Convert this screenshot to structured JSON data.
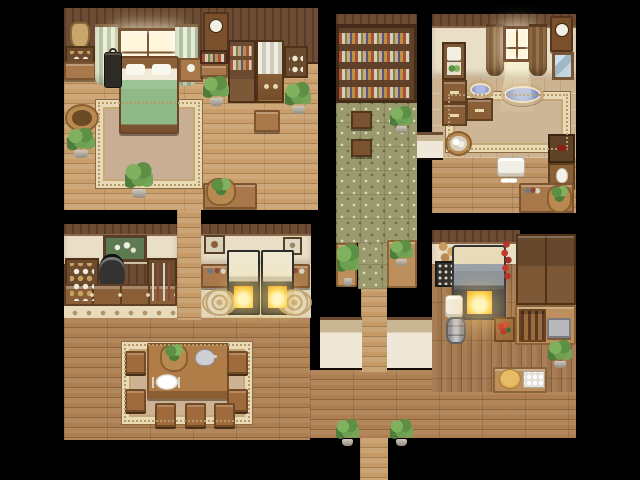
{
  "scene": {
    "kind": "rpg-top-down-interior-map",
    "rooms": [
      "bedroom",
      "library-corridor",
      "bathroom",
      "apothecary",
      "oven-room",
      "kitchen",
      "dining-hall"
    ]
  },
  "canvas": {
    "width": 640,
    "height": 480,
    "background": "#000000"
  },
  "palette": {
    "void": "#000000",
    "hall_floor": "#ac7e50",
    "light_floor": "#c59a66",
    "kitchen_floor": "#a0744a",
    "library_tile": "#9a9a6e",
    "bath_tile": "#ccb492",
    "cream_tile": "#e4d7b8",
    "wall_wood": "#6d4c33",
    "wall_cream": "#e9dfc6",
    "wall_plaster": "#efe8d8",
    "rug_border": "#ead9b5",
    "bed_blanket": "#8fba88",
    "water_blue": "#7e8cc4",
    "fire_glow": "#ffd95e",
    "plant_green": "#5d8f44"
  },
  "sprites": [
    {
      "name": "hall-floor-left",
      "type": "floor-h",
      "x": 64,
      "y": 318,
      "w": 246,
      "h": 122
    },
    {
      "name": "hall-floor-right",
      "type": "floor-h",
      "x": 310,
      "y": 370,
      "w": 266,
      "h": 68
    },
    {
      "name": "exit-corridor-floor",
      "type": "floor-h-light",
      "x": 360,
      "y": 438,
      "w": 28,
      "h": 42
    },
    {
      "name": "mid-corridor-floor",
      "type": "floor-h-light",
      "x": 177,
      "y": 208,
      "w": 24,
      "h": 112
    },
    {
      "name": "center-walkway-floor",
      "type": "floor-h-light",
      "x": 361,
      "y": 287,
      "w": 26,
      "h": 85
    },
    {
      "name": "bedroom-floor",
      "type": "floor-h-light",
      "x": 64,
      "y": 64,
      "w": 254,
      "h": 146,
      "bg": "#c99e6a"
    },
    {
      "name": "bedroom-wall",
      "type": "wall-wood",
      "x": 64,
      "y": 8,
      "w": 254,
      "h": 56
    },
    {
      "name": "library-wall-cap",
      "type": "wall-wood",
      "x": 336,
      "y": 14,
      "w": 81,
      "h": 12
    },
    {
      "name": "library-bookshelf-wall",
      "type": "bookshelf-big",
      "x": 336,
      "y": 25,
      "w": 81,
      "h": 78
    },
    {
      "name": "library-floor",
      "type": "floor-green",
      "x": 336,
      "y": 103,
      "w": 81,
      "h": 140
    },
    {
      "name": "library-floor-strip",
      "type": "floor-green",
      "x": 358,
      "y": 243,
      "w": 29,
      "h": 46
    },
    {
      "name": "library-table-left",
      "type": "table-tan",
      "x": 336,
      "y": 243,
      "w": 21,
      "h": 44
    },
    {
      "name": "library-table-right",
      "type": "table-tan",
      "x": 387,
      "y": 240,
      "w": 30,
      "h": 48
    },
    {
      "name": "bathroom-wall-cap",
      "type": "wall-wood",
      "x": 432,
      "y": 14,
      "w": 144,
      "h": 14
    },
    {
      "name": "bathroom-wall",
      "type": "wall-cream",
      "x": 432,
      "y": 26,
      "w": 144,
      "h": 52
    },
    {
      "name": "bathroom-tile-floor",
      "type": "floor-tile-beige",
      "x": 432,
      "y": 78,
      "w": 144,
      "h": 80
    },
    {
      "name": "bathroom-wood-floor",
      "type": "floor-h-light",
      "x": 432,
      "y": 158,
      "w": 144,
      "h": 55,
      "bg": "#bc8f5e"
    },
    {
      "name": "apothecary-wall-cap",
      "type": "wall-wood",
      "x": 64,
      "y": 224,
      "w": 113,
      "h": 12
    },
    {
      "name": "apothecary-wall",
      "type": "wall-cream",
      "x": 64,
      "y": 234,
      "w": 113,
      "h": 32
    },
    {
      "name": "apothecary-panel",
      "type": "wall-wood",
      "x": 64,
      "y": 264,
      "w": 113,
      "h": 42
    },
    {
      "name": "apothecary-tile-strip",
      "type": "tile-strip",
      "x": 64,
      "y": 304,
      "w": 113,
      "h": 14
    },
    {
      "name": "ovenroom-wall-cap",
      "type": "wall-wood",
      "x": 201,
      "y": 224,
      "w": 110,
      "h": 12
    },
    {
      "name": "ovenroom-wall",
      "type": "wall-cream",
      "x": 201,
      "y": 234,
      "w": 110,
      "h": 32
    },
    {
      "name": "ovenroom-floor",
      "type": "floor-tile-cream",
      "x": 201,
      "y": 264,
      "w": 110,
      "h": 54
    },
    {
      "name": "south-wall-left",
      "type": "wall-plaster",
      "x": 320,
      "y": 317,
      "w": 42,
      "h": 53
    },
    {
      "name": "south-wall-right",
      "type": "wall-plaster",
      "x": 387,
      "y": 317,
      "w": 51,
      "h": 53
    },
    {
      "name": "library-bath-wall",
      "type": "wall-plaster",
      "x": 417,
      "y": 132,
      "w": 26,
      "h": 28
    },
    {
      "name": "kitchen-wall-cap",
      "type": "wall-wood",
      "x": 432,
      "y": 230,
      "w": 88,
      "h": 14
    },
    {
      "name": "kitchen-wall",
      "type": "wall-cream",
      "x": 432,
      "y": 242,
      "w": 88,
      "h": 46
    },
    {
      "name": "kitchen-floor",
      "type": "floor-v",
      "x": 432,
      "y": 264,
      "w": 144,
      "h": 128
    },
    {
      "name": "bedroom-rug",
      "type": "rug",
      "x": 96,
      "y": 100,
      "w": 106,
      "h": 88,
      "bg": "#c7ae94"
    },
    {
      "name": "bathroom-rug",
      "type": "rug",
      "x": 446,
      "y": 92,
      "w": 124,
      "h": 60,
      "bg": "#cdb695"
    },
    {
      "name": "dining-carpet",
      "type": "rug",
      "x": 122,
      "y": 342,
      "w": 130,
      "h": 82,
      "bg": "#cdb394"
    },
    {
      "name": "hanging-pouch",
      "type": "pouch",
      "x": 70,
      "y": 22,
      "w": 20,
      "h": 28
    },
    {
      "name": "blue-jar-shelf",
      "type": "shelf-unit",
      "x": 65,
      "y": 46,
      "w": 30,
      "h": 18
    },
    {
      "name": "bedroom-side-table",
      "type": "table",
      "x": 64,
      "y": 62,
      "w": 32,
      "h": 18
    },
    {
      "name": "bedroom-curtain-left",
      "type": "curtain-striped",
      "x": 95,
      "y": 24,
      "w": 23,
      "h": 62
    },
    {
      "name": "bedroom-window",
      "type": "window",
      "x": 118,
      "y": 28,
      "w": 60,
      "h": 40
    },
    {
      "name": "bedroom-curtain-right",
      "type": "curtain-striped",
      "x": 175,
      "y": 24,
      "w": 23,
      "h": 62
    },
    {
      "name": "bed",
      "type": "bed",
      "x": 119,
      "y": 56,
      "w": 60,
      "h": 78
    },
    {
      "name": "lantern",
      "type": "lantern",
      "x": 104,
      "y": 52,
      "w": 18,
      "h": 36
    },
    {
      "name": "nightstand",
      "type": "nightstand",
      "x": 179,
      "y": 58,
      "w": 24,
      "h": 24
    },
    {
      "name": "bedroom-wall-clock",
      "type": "clock",
      "x": 203,
      "y": 12,
      "w": 26,
      "h": 40
    },
    {
      "name": "bedroom-books-row",
      "type": "books-row",
      "x": 200,
      "y": 50,
      "w": 28,
      "h": 14
    },
    {
      "name": "bedroom-bench-small",
      "type": "table",
      "x": 200,
      "y": 64,
      "w": 28,
      "h": 13
    },
    {
      "name": "bedroom-bookshelf",
      "type": "bookshelf-tall",
      "x": 228,
      "y": 40,
      "w": 28,
      "h": 63
    },
    {
      "name": "linen-cabinet",
      "type": "linen-cabinet",
      "x": 256,
      "y": 40,
      "w": 28,
      "h": 63
    },
    {
      "name": "dish-shelf",
      "type": "dish-shelf",
      "x": 284,
      "y": 46,
      "w": 24,
      "h": 32
    },
    {
      "name": "bedroom-plant-1",
      "type": "plant",
      "x": 203,
      "y": 76,
      "w": 26,
      "h": 30
    },
    {
      "name": "bedroom-plant-2",
      "type": "plant",
      "x": 285,
      "y": 82,
      "w": 26,
      "h": 32
    },
    {
      "name": "bedroom-desk",
      "type": "table",
      "x": 254,
      "y": 110,
      "w": 26,
      "h": 22
    },
    {
      "name": "soil-basket",
      "type": "basket",
      "x": 65,
      "y": 104,
      "w": 34,
      "h": 28
    },
    {
      "name": "bedroom-plant-3",
      "type": "plant",
      "x": 67,
      "y": 128,
      "w": 28,
      "h": 30
    },
    {
      "name": "bedroom-plant-4",
      "type": "plant",
      "x": 125,
      "y": 162,
      "w": 28,
      "h": 36
    },
    {
      "name": "bedroom-bench-long",
      "type": "table",
      "x": 203,
      "y": 183,
      "w": 54,
      "h": 26
    },
    {
      "name": "greens-basket",
      "type": "basket-greens",
      "x": 206,
      "y": 178,
      "w": 30,
      "h": 28
    },
    {
      "name": "library-stool-1",
      "type": "stool",
      "x": 351,
      "y": 111,
      "w": 21,
      "h": 18
    },
    {
      "name": "library-stool-2",
      "type": "stool",
      "x": 351,
      "y": 139,
      "w": 21,
      "h": 18
    },
    {
      "name": "library-plant-1",
      "type": "plant",
      "x": 390,
      "y": 106,
      "w": 23,
      "h": 27
    },
    {
      "name": "library-plant-tall",
      "type": "plant-tall",
      "x": 337,
      "y": 242,
      "w": 22,
      "h": 44
    },
    {
      "name": "library-plant-2",
      "type": "plant",
      "x": 390,
      "y": 240,
      "w": 23,
      "h": 26
    },
    {
      "name": "towel-shelf",
      "type": "towel-shelf",
      "x": 442,
      "y": 42,
      "w": 24,
      "h": 38
    },
    {
      "name": "bath-curtain-left",
      "type": "curtain-brown",
      "x": 486,
      "y": 24,
      "w": 18,
      "h": 52
    },
    {
      "name": "bath-window",
      "type": "window",
      "x": 503,
      "y": 26,
      "w": 28,
      "h": 36
    },
    {
      "name": "bath-curtain-right",
      "type": "curtain-brown",
      "x": 529,
      "y": 24,
      "w": 18,
      "h": 52
    },
    {
      "name": "bath-light-beam",
      "type": "beam",
      "x": 499,
      "y": 62,
      "w": 36,
      "h": 50
    },
    {
      "name": "bath-wall-clock",
      "type": "clock",
      "x": 550,
      "y": 16,
      "w": 23,
      "h": 36
    },
    {
      "name": "bath-mirror",
      "type": "mirror",
      "x": 552,
      "y": 52,
      "w": 22,
      "h": 28
    },
    {
      "name": "bath-cabinet-1",
      "type": "cabinet",
      "x": 442,
      "y": 80,
      "w": 25,
      "h": 23
    },
    {
      "name": "bath-cabinet-2",
      "type": "cabinet",
      "x": 442,
      "y": 103,
      "w": 25,
      "h": 23
    },
    {
      "name": "bath-cabinet-3",
      "type": "cabinet",
      "x": 466,
      "y": 98,
      "w": 27,
      "h": 23
    },
    {
      "name": "wash-basin-small",
      "type": "basin",
      "x": 467,
      "y": 80,
      "w": 27,
      "h": 19
    },
    {
      "name": "wash-basin-large",
      "type": "basin",
      "x": 501,
      "y": 83,
      "w": 43,
      "h": 23
    },
    {
      "name": "towel-basket",
      "type": "basket-towels",
      "x": 445,
      "y": 131,
      "w": 27,
      "h": 25
    },
    {
      "name": "bath-side-table",
      "type": "side-table-dark",
      "x": 548,
      "y": 134,
      "w": 27,
      "h": 29
    },
    {
      "name": "washstand",
      "type": "washstand",
      "x": 548,
      "y": 163,
      "w": 27,
      "h": 27
    },
    {
      "name": "towel-pile",
      "type": "towel-stack",
      "x": 497,
      "y": 157,
      "w": 28,
      "h": 20
    },
    {
      "name": "slippers",
      "type": "slippers",
      "x": 501,
      "y": 176,
      "w": 16,
      "h": 9
    },
    {
      "name": "bath-desk",
      "type": "table",
      "x": 519,
      "y": 183,
      "w": 55,
      "h": 30
    },
    {
      "name": "bath-bottles",
      "type": "bottles",
      "x": 523,
      "y": 183,
      "w": 18,
      "h": 13
    },
    {
      "name": "bath-plant-basket",
      "type": "basket-greens",
      "x": 547,
      "y": 185,
      "w": 25,
      "h": 28
    },
    {
      "name": "onion-strings",
      "type": "onions",
      "x": 436,
      "y": 239,
      "w": 24,
      "h": 30
    },
    {
      "name": "spice-rack",
      "type": "spice-rack",
      "x": 435,
      "y": 261,
      "w": 22,
      "h": 26
    },
    {
      "name": "kitchen-stove",
      "type": "stove",
      "x": 452,
      "y": 245,
      "w": 54,
      "h": 75
    },
    {
      "name": "pepper-strings",
      "type": "peppers",
      "x": 499,
      "y": 239,
      "w": 15,
      "h": 44
    },
    {
      "name": "kitchen-towel-stack",
      "type": "towel-stack",
      "x": 445,
      "y": 295,
      "w": 18,
      "h": 23
    },
    {
      "name": "milk-barrel",
      "type": "barrel",
      "x": 446,
      "y": 317,
      "w": 20,
      "h": 27
    },
    {
      "name": "kitchen-cupboards",
      "type": "cupboard-tall",
      "x": 516,
      "y": 234,
      "w": 60,
      "h": 71
    },
    {
      "name": "kitchen-side-counter",
      "type": "table-tan",
      "x": 515,
      "y": 305,
      "w": 61,
      "h": 40
    },
    {
      "name": "bottle-crate",
      "type": "crate-bottles",
      "x": 519,
      "y": 309,
      "w": 27,
      "h": 33
    },
    {
      "name": "grinder",
      "type": "grinder",
      "x": 547,
      "y": 318,
      "w": 24,
      "h": 20
    },
    {
      "name": "veggie-crate",
      "type": "crate-veg",
      "x": 494,
      "y": 317,
      "w": 21,
      "h": 25
    },
    {
      "name": "kitchen-plant",
      "type": "plant",
      "x": 548,
      "y": 340,
      "w": 24,
      "h": 28
    },
    {
      "name": "kitchen-counter",
      "type": "table-tan",
      "x": 493,
      "y": 367,
      "w": 54,
      "h": 26
    },
    {
      "name": "bread-loaf",
      "type": "bread",
      "x": 499,
      "y": 369,
      "w": 22,
      "h": 20
    },
    {
      "name": "egg-tray",
      "type": "egg-tray",
      "x": 523,
      "y": 371,
      "w": 22,
      "h": 17
    },
    {
      "name": "flower-painting",
      "type": "painting-flowers",
      "x": 103,
      "y": 235,
      "w": 44,
      "h": 27
    },
    {
      "name": "apothecary-shelf-left",
      "type": "shelf-unit",
      "x": 65,
      "y": 258,
      "w": 34,
      "h": 48
    },
    {
      "name": "hanging-pot",
      "type": "hanging-pot",
      "x": 99,
      "y": 254,
      "w": 26,
      "h": 36
    },
    {
      "name": "apothecary-shelf-right",
      "type": "shelf-bottles",
      "x": 147,
      "y": 258,
      "w": 30,
      "h": 48
    },
    {
      "name": "apothecary-cabinets",
      "type": "cabinet-row",
      "x": 64,
      "y": 284,
      "w": 113,
      "h": 22
    },
    {
      "name": "bird-painting",
      "type": "painting-bird",
      "x": 204,
      "y": 235,
      "w": 21,
      "h": 19
    },
    {
      "name": "small-painting",
      "type": "painting-small",
      "x": 283,
      "y": 237,
      "w": 19,
      "h": 18
    },
    {
      "name": "oven-table-left",
      "type": "table",
      "x": 201,
      "y": 264,
      "w": 31,
      "h": 24
    },
    {
      "name": "oven-table-left-bottles",
      "type": "bottles",
      "x": 204,
      "y": 264,
      "w": 24,
      "h": 12
    },
    {
      "name": "oven-table-right",
      "type": "table",
      "x": 277,
      "y": 264,
      "w": 33,
      "h": 24
    },
    {
      "name": "oven-table-right-bottles",
      "type": "bottles",
      "x": 281,
      "y": 264,
      "w": 26,
      "h": 12
    },
    {
      "name": "oven-1",
      "type": "oven",
      "x": 227,
      "y": 250,
      "w": 33,
      "h": 65
    },
    {
      "name": "oven-2",
      "type": "oven",
      "x": 261,
      "y": 250,
      "w": 33,
      "h": 65
    },
    {
      "name": "floor-medallion-1",
      "type": "medallion",
      "x": 202,
      "y": 289,
      "w": 35,
      "h": 27
    },
    {
      "name": "floor-medallion-2",
      "type": "medallion",
      "x": 277,
      "y": 289,
      "w": 35,
      "h": 27
    },
    {
      "name": "dining-table",
      "type": "dining-table",
      "x": 147,
      "y": 343,
      "w": 82,
      "h": 56
    },
    {
      "name": "table-centerpiece-plant",
      "type": "basket-greens",
      "x": 160,
      "y": 344,
      "w": 28,
      "h": 28
    },
    {
      "name": "teapot",
      "type": "teapot",
      "x": 195,
      "y": 349,
      "w": 20,
      "h": 17
    },
    {
      "name": "place-setting",
      "type": "plate-setting",
      "x": 151,
      "y": 371,
      "w": 32,
      "h": 22
    },
    {
      "name": "dining-chair-left-1",
      "type": "chair",
      "x": 125,
      "y": 351,
      "w": 21,
      "h": 23
    },
    {
      "name": "dining-chair-left-2",
      "type": "chair",
      "x": 125,
      "y": 389,
      "w": 21,
      "h": 23
    },
    {
      "name": "dining-chair-right-1",
      "type": "chair",
      "x": 227,
      "y": 351,
      "w": 21,
      "h": 23
    },
    {
      "name": "dining-chair-right-2",
      "type": "chair",
      "x": 227,
      "y": 389,
      "w": 21,
      "h": 23
    },
    {
      "name": "dining-chair-bottom-1",
      "type": "chair",
      "x": 155,
      "y": 403,
      "w": 21,
      "h": 24
    },
    {
      "name": "dining-chair-bottom-2",
      "type": "chair",
      "x": 185,
      "y": 403,
      "w": 21,
      "h": 24
    },
    {
      "name": "dining-chair-bottom-3",
      "type": "chair",
      "x": 214,
      "y": 403,
      "w": 21,
      "h": 24
    },
    {
      "name": "exit-plant-left",
      "type": "plant",
      "x": 336,
      "y": 419,
      "w": 23,
      "h": 27
    },
    {
      "name": "exit-plant-right",
      "type": "plant",
      "x": 390,
      "y": 419,
      "w": 23,
      "h": 27
    }
  ]
}
